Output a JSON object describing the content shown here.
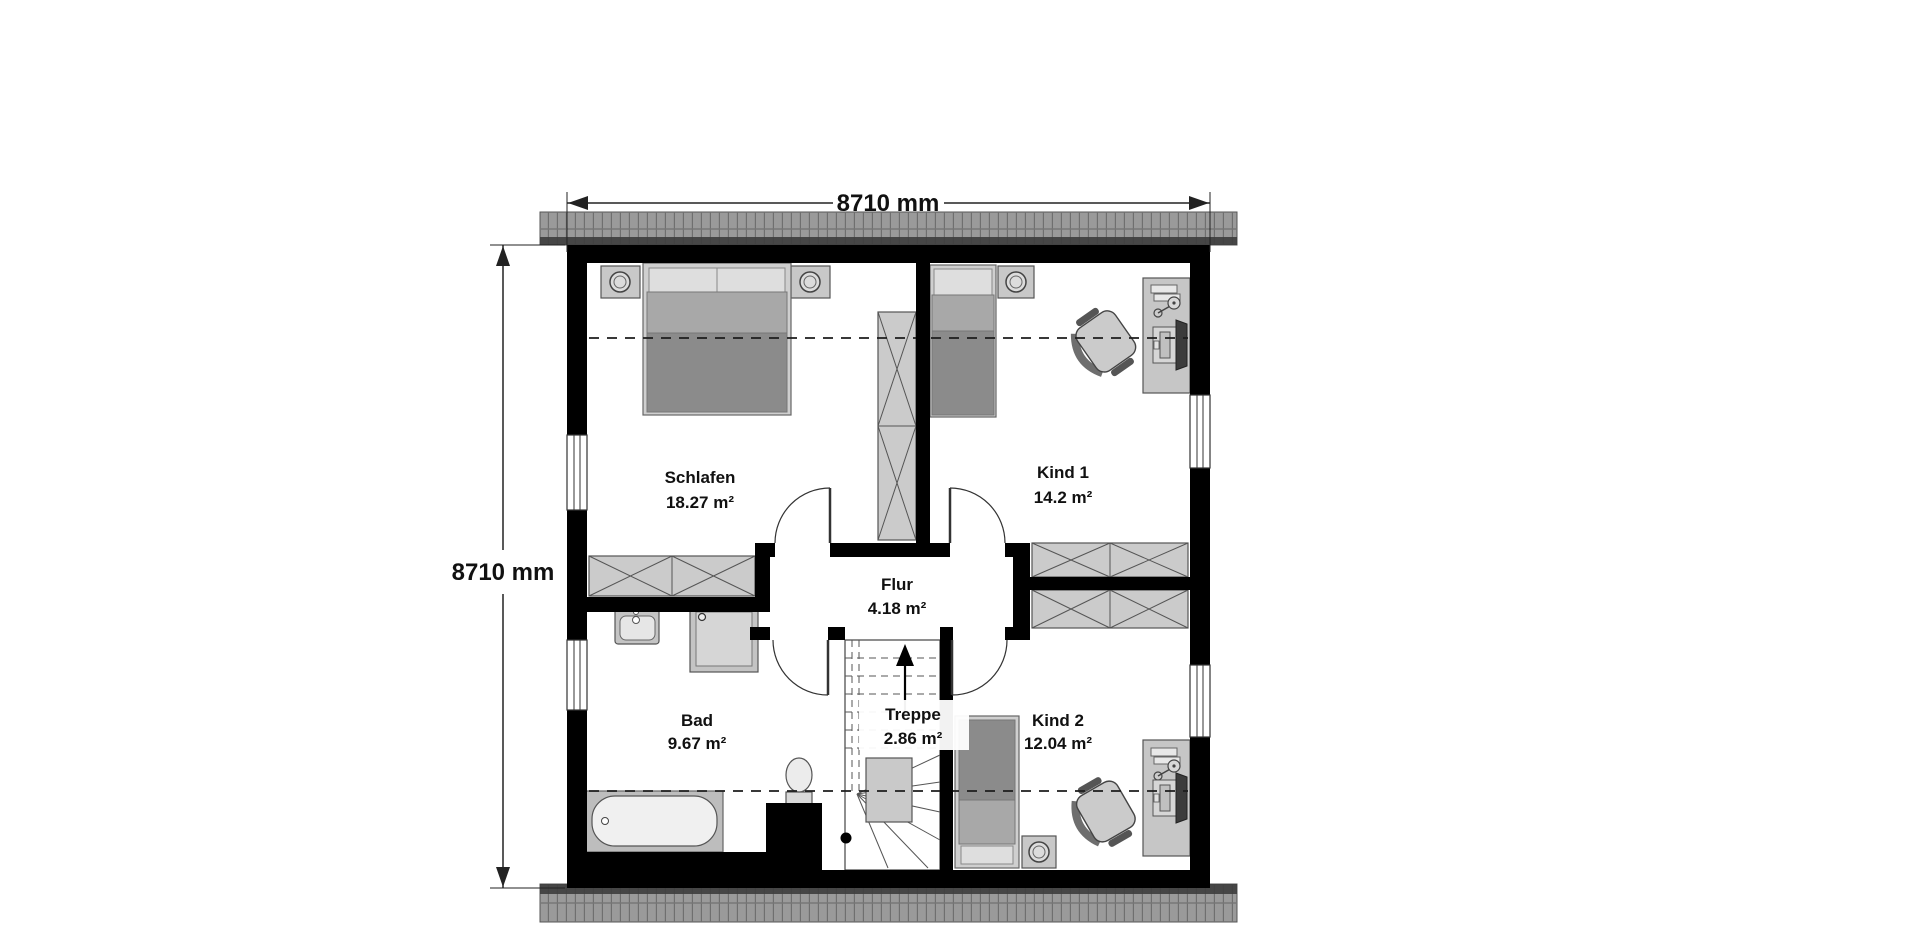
{
  "plan": {
    "title": "attic floor plan",
    "dimension_top": "8710 mm",
    "dimension_left": "8710 mm",
    "rooms": [
      {
        "name": "Schlafen",
        "area": "18.27 m²"
      },
      {
        "name": "Kind 1",
        "area": "14.2 m²"
      },
      {
        "name": "Flur",
        "area": "4.18 m²"
      },
      {
        "name": "Bad",
        "area": "9.67 m²"
      },
      {
        "name": "Treppe",
        "area": "2.86 m²"
      },
      {
        "name": "Kind 2",
        "area": "12.04 m²"
      }
    ],
    "colors": {
      "wall": "#000000",
      "roof_tile": "#9a9a9a",
      "roof_shadow": "#3d3d3d",
      "wardrobe_fill": "#cbcbcb",
      "furniture_light": "#dedede",
      "furniture_mid": "#a8a8a8",
      "furniture_dark": "#8b8b8b",
      "fixture_fill": "#d6d6d6",
      "line": "#444444"
    },
    "icons": [
      "double-bed-icon",
      "single-bed-icon",
      "nightstand-icon",
      "lamp-icon",
      "wardrobe-icon",
      "desk-icon",
      "office-chair-icon",
      "monitor-icon",
      "desk-lamp-icon",
      "books-icon",
      "bathtub-icon",
      "shower-icon",
      "washbasin-icon",
      "toilet-icon",
      "stairs-icon",
      "chimney-icon",
      "door-swing-icon",
      "window-icon",
      "dimension-arrow-icon",
      "stair-direction-arrow-icon",
      "roof-eaves-icon",
      "knee-height-line-icon"
    ]
  }
}
